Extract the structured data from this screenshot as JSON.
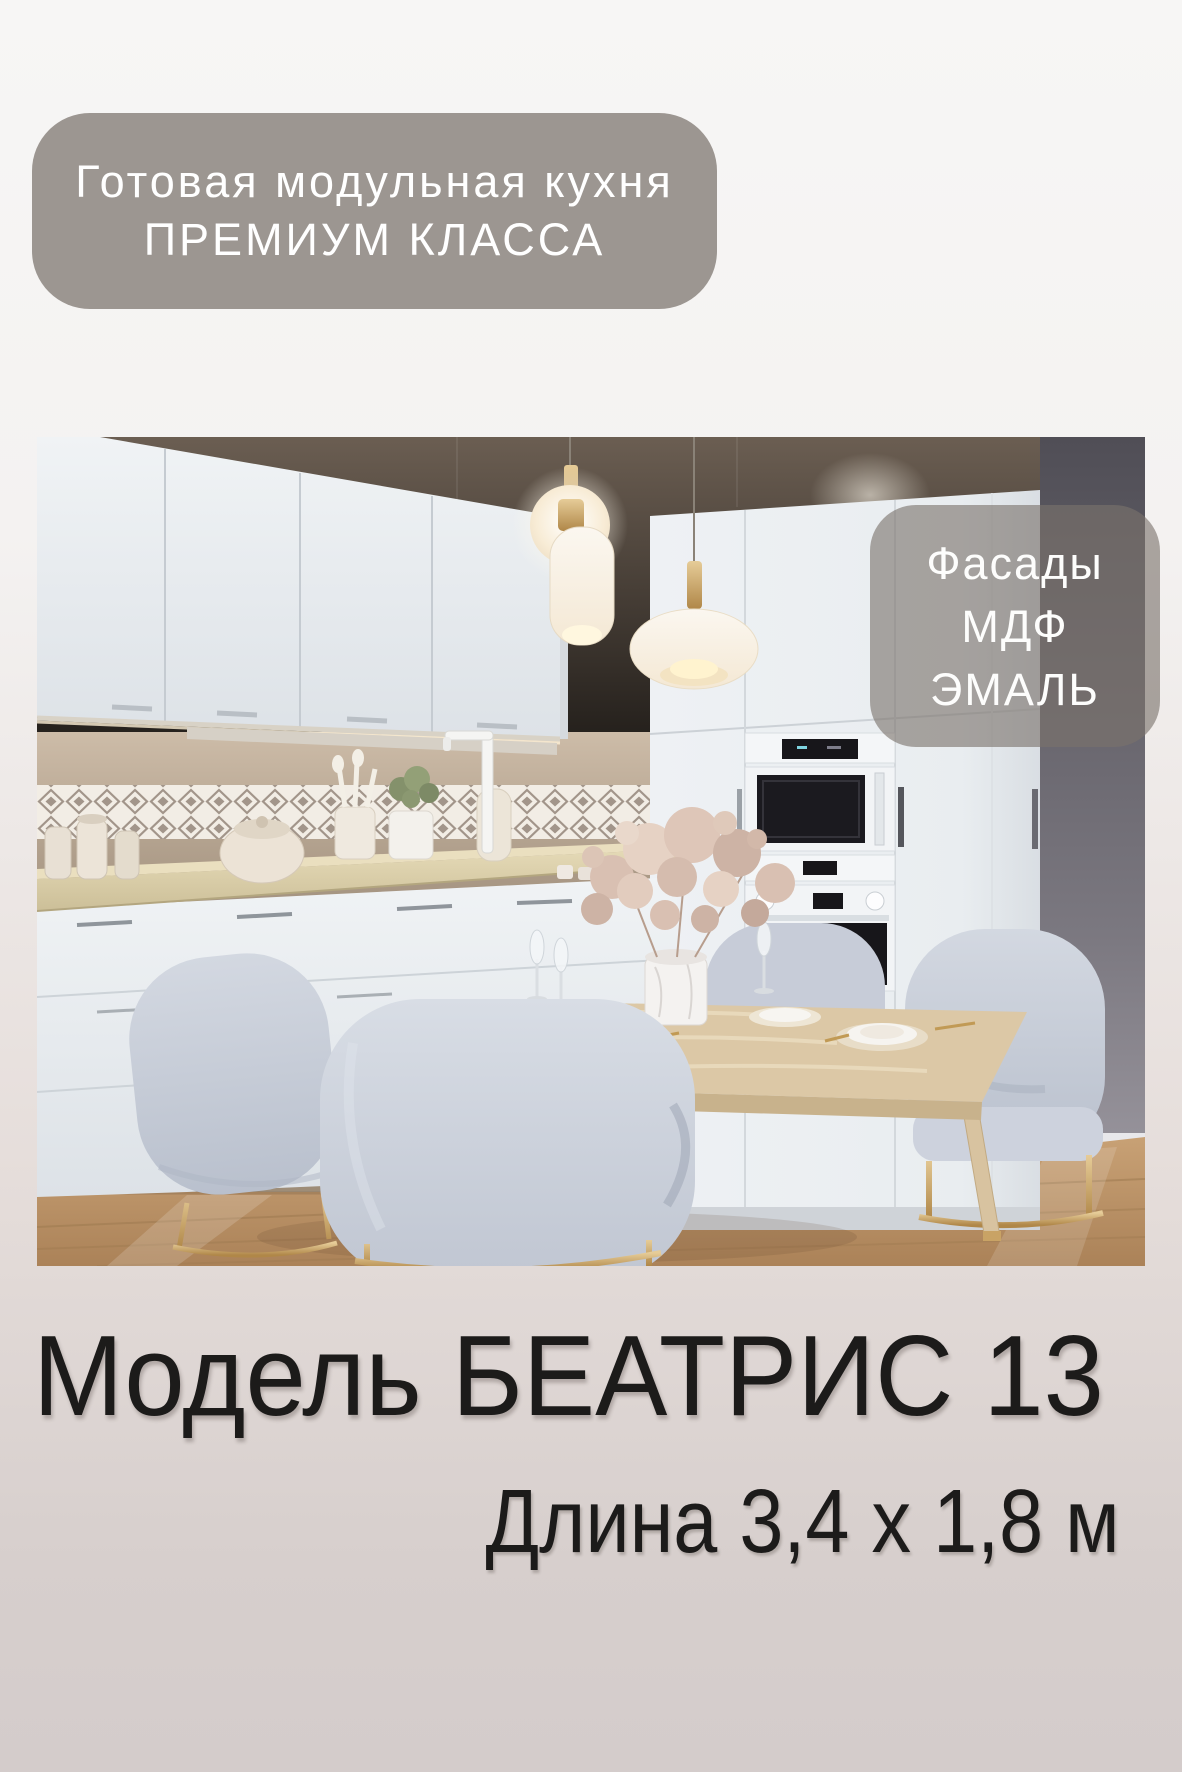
{
  "card": {
    "background": {
      "top_color": "#f6f5f4",
      "bottom_color": "#d4cccb"
    },
    "header_badge": {
      "line1": "Готовая модульная кухня",
      "line2": "ПРЕМИУМ КЛАССА",
      "background_color": "#9c9691",
      "text_color": "#ffffff"
    },
    "photo": {
      "subject": "kitchen-interior-render",
      "overlay_badge": {
        "line1": "Фасады",
        "line2": "МДФ",
        "line3": "ЭМАЛЬ",
        "background_color": "rgba(122,115,108,0.62)",
        "text_color": "#fdfdfc"
      },
      "palette": {
        "wall_taupe": "#7a6c5f",
        "wall_dark_gray": "#55535b",
        "cabinet_white": "#ecf0f3",
        "countertop_marble": "#dcd1ab",
        "floor_wood": "#bd9569",
        "chair_fabric": "#c8cdd8",
        "metal_gold": "#c9a365"
      }
    },
    "footer": {
      "model_text": "Модель БЕАТРИС 13",
      "dimensions_text": "Длина 3,4 х 1,8 м",
      "text_color": "#1c1b1a"
    }
  }
}
